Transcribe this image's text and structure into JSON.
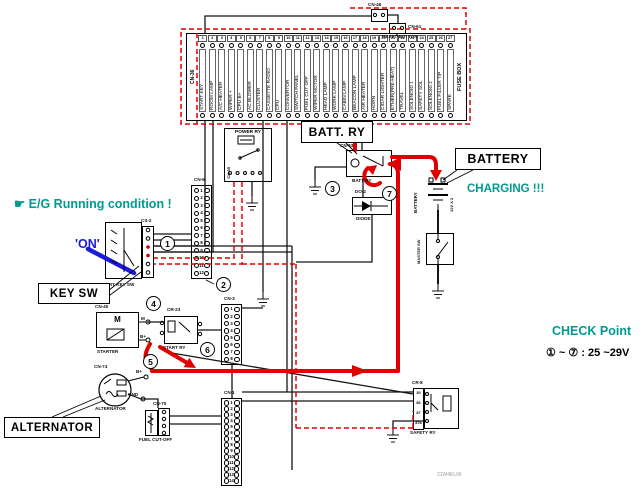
{
  "colors": {
    "teal": "#009a93",
    "flow_red": "#e10000",
    "blue": "#1a1adf",
    "wire": "#141414"
  },
  "annotations": {
    "running_condition": "☛ E/G Running condition !",
    "on_state": "'ON'",
    "charging": "CHARGING !!!",
    "check_title": "CHECK Point",
    "check_value": "① ~ ⑦ : 25 ~29V",
    "watermark": "21W4EL06"
  },
  "callouts": {
    "key_sw": "KEY SW",
    "batt_ry": "BATT. RY",
    "battery": "BATTERY",
    "alternator": "ALTERNATOR"
  },
  "checkpoints": [
    "1",
    "2",
    "3",
    "4",
    "5",
    "6",
    "7"
  ],
  "fusebox": {
    "connector": "CN-36",
    "name": "FUSE BOX",
    "fuses": [
      {
        "no": "1",
        "label": "START KEY"
      },
      {
        "no": "2",
        "label": "ROOM LAMP"
      },
      {
        "no": "3",
        "label": "A/C HEATER"
      },
      {
        "no": "4",
        "label": "WIPER +"
      },
      {
        "no": "5",
        "label": "CPU B+"
      },
      {
        "no": "6",
        "label": "AC BLOWER"
      },
      {
        "no": "7",
        "label": "CLUSTER"
      },
      {
        "no": "8",
        "label": "CASSETTE RADIO"
      },
      {
        "no": "9",
        "label": "CPU"
      },
      {
        "no": "10",
        "label": "CONVERTOR"
      },
      {
        "no": "11",
        "label": "SWITCH PANEL"
      },
      {
        "no": "12",
        "label": "FUEL CUT OFF"
      },
      {
        "no": "13",
        "label": "WIPER MOTOR"
      },
      {
        "no": "14",
        "label": "HEAD LAMP"
      },
      {
        "no": "15",
        "label": "WORK LAMP"
      },
      {
        "no": "16",
        "label": "CABIN LAMP"
      },
      {
        "no": "17",
        "label": "BEACON LAMP"
      },
      {
        "no": "18",
        "label": "AIR HEATER"
      },
      {
        "no": "19",
        "label": "HORN"
      },
      {
        "no": "20",
        "label": "CIGAR LIGHTER"
      },
      {
        "no": "21",
        "label": "ETHER(PRE-HEAT)"
      },
      {
        "no": "22",
        "label": "TRAVEL"
      },
      {
        "no": "23",
        "label": "SOLENOID 1"
      },
      {
        "no": "24",
        "label": "SAFETY SOL"
      },
      {
        "no": "25",
        "label": "SOLENOID 2"
      },
      {
        "no": "26",
        "label": "FUEL FILLER T/P"
      },
      {
        "no": "27",
        "label": "SPARE"
      }
    ]
  },
  "reset": {
    "cn_a": "CN-46",
    "cn_b": "CN-61",
    "label": "RESET BUTTON"
  },
  "power_relay": {
    "title": "POWER RY",
    "connector": "CN-35"
  },
  "batt_relay": {
    "connector": "CN-33",
    "label": "BATT RY"
  },
  "diode": {
    "connector": "DO-2",
    "label": "DIODE"
  },
  "battery": {
    "label": "BATTERY",
    "spec": "12V X 2"
  },
  "master_sw": {
    "label": "MASTER SW"
  },
  "key_switch": {
    "connector": "CS-2",
    "label": "START KEY SW"
  },
  "cn6": {
    "label": "CN-6",
    "pins": [
      "1",
      "2",
      "3",
      "4",
      "5",
      "6",
      "7",
      "8",
      "9",
      "10",
      "11",
      "12"
    ]
  },
  "starter": {
    "connector": "CN-40",
    "label": "STARTER",
    "motor": "M",
    "pin_m": "M",
    "pin_b": "B+"
  },
  "start_relay": {
    "connector": "CR-23",
    "label": "START RY"
  },
  "alternator": {
    "connector": "CN-74",
    "label": "ALTERNATOR",
    "pin_b": "B+",
    "pin_gnd": "GND"
  },
  "fuel_cutoff": {
    "connector": "CN-70",
    "label": "FUEL CUT-OFF"
  },
  "cn1": {
    "label": "CN-1",
    "pins": [
      "1",
      "2",
      "3",
      "4",
      "5",
      "6",
      "7",
      "8",
      "9",
      "10",
      "11",
      "12",
      "13",
      "14"
    ]
  },
  "cn3": {
    "label": "CN-3",
    "pins": [
      "1",
      "2",
      "3",
      "4",
      "5",
      "6",
      "7",
      "8"
    ]
  },
  "safety_relay": {
    "connector": "CR-8",
    "label": "SAFETY RY",
    "pins": [
      "30",
      "86",
      "87",
      "87a"
    ]
  }
}
